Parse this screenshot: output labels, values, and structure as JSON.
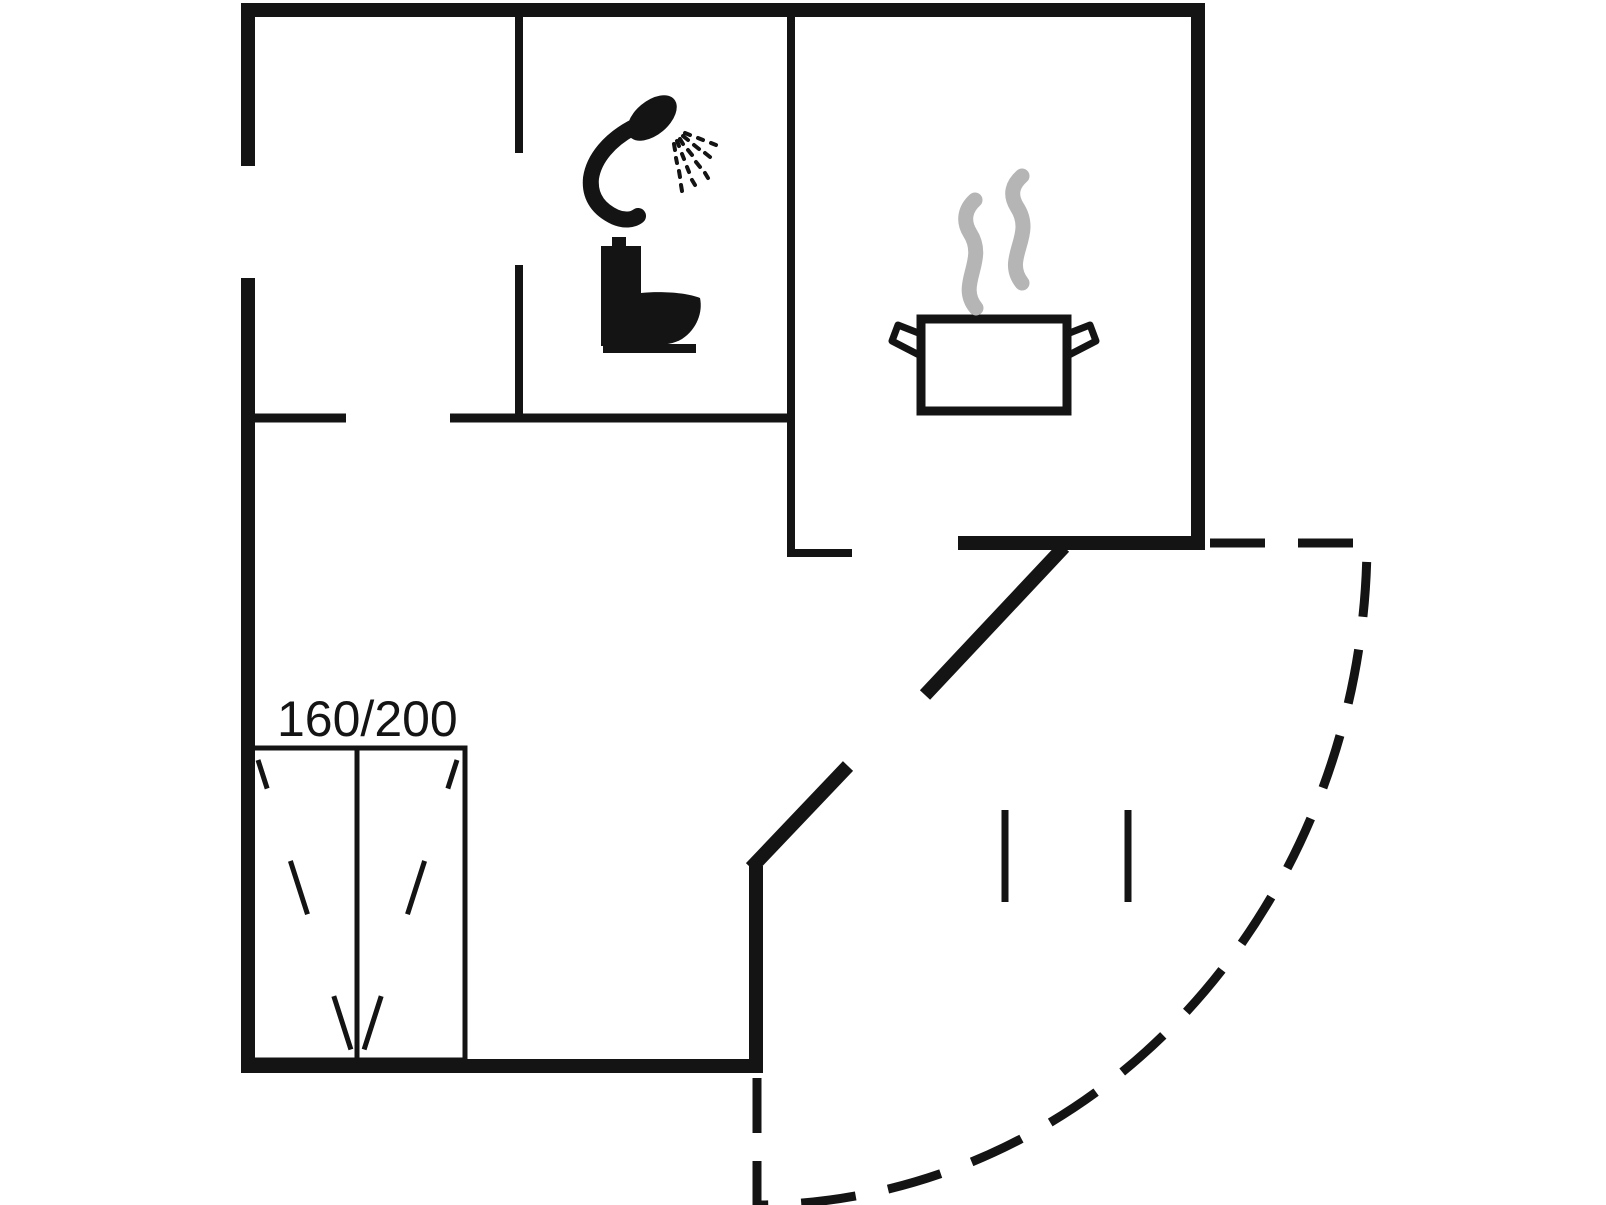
{
  "colors": {
    "wall": "#141414",
    "steam": "#b5b5b5",
    "background": "#ffffff"
  },
  "bed": {
    "label": "160/200"
  },
  "icons": {
    "shower": "shower-icon",
    "toilet": "toilet-icon",
    "cooking_pot": "cooking-pot-icon",
    "steam": "steam-icon"
  }
}
